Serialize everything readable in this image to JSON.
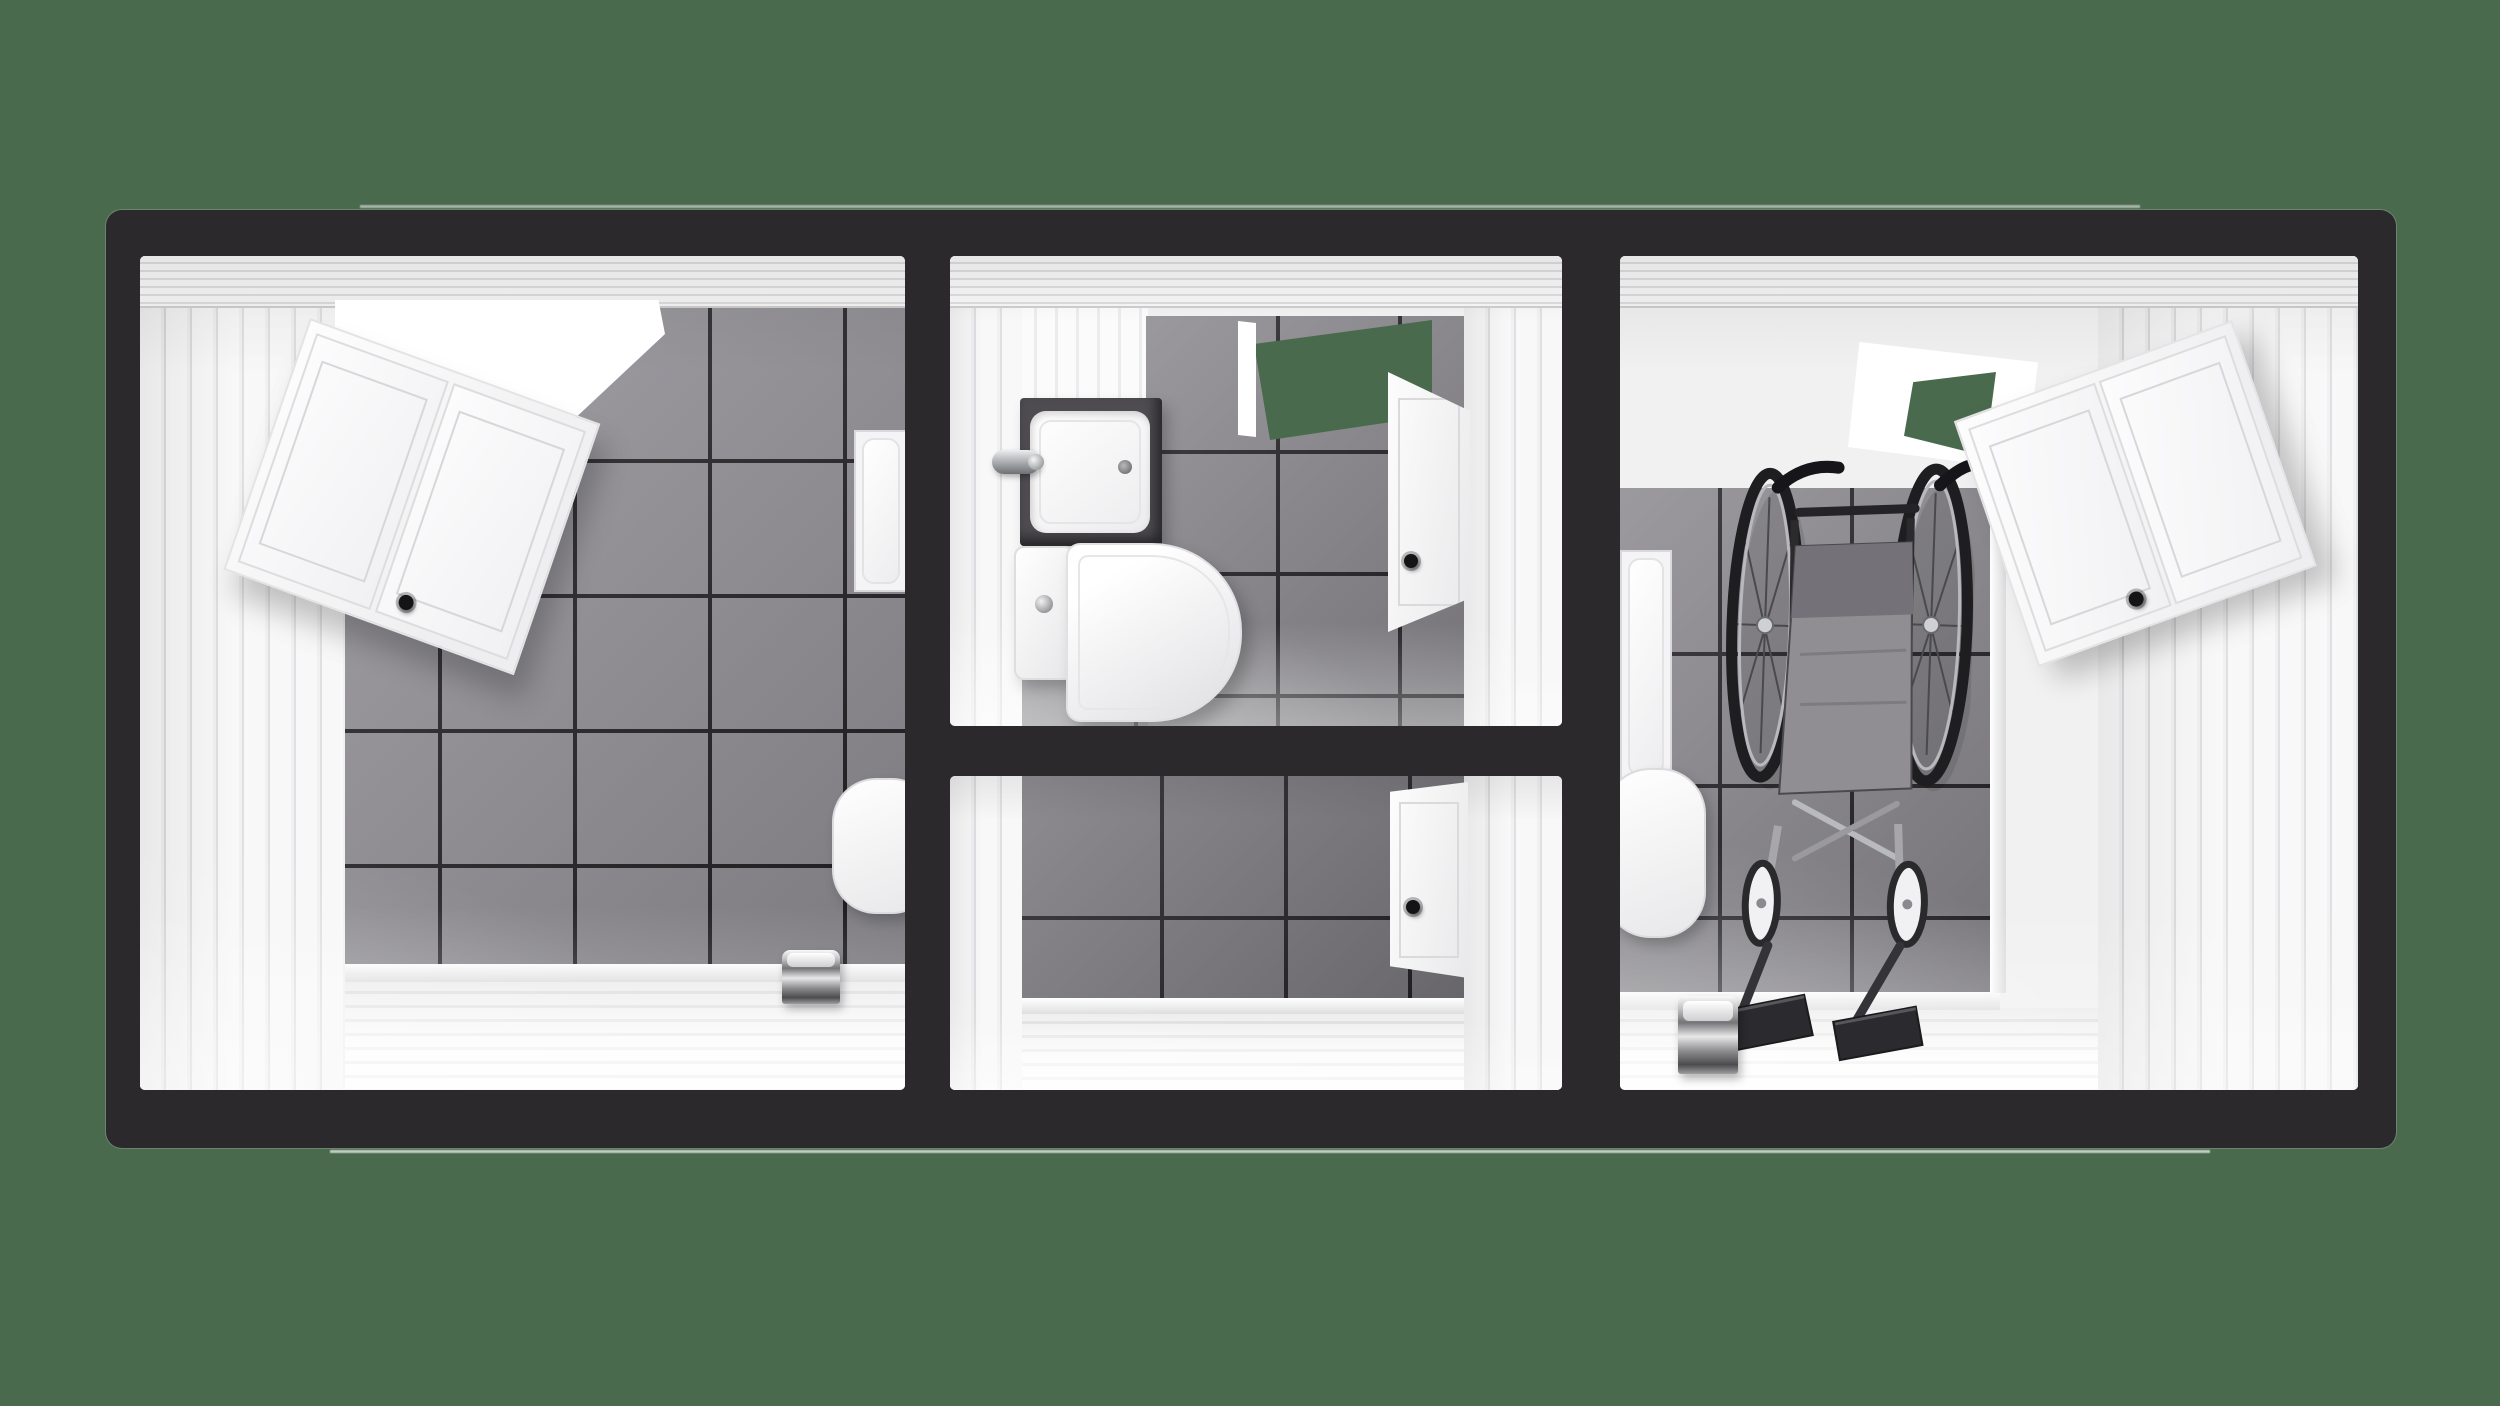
{
  "title": "Three-room modular sanitary container, top-down cutaway 3D render on transparent green background",
  "colors": {
    "bg-green": "#4a6a4e",
    "frame": "#2b292c",
    "grout": "#232125",
    "tile-light": "#949298",
    "tile-mid": "#8a888d",
    "tile-dark": "#7b797e",
    "plank-white": "#f2f1f2"
  },
  "container": {
    "frame_material": "dark charcoal steel frame",
    "room_count": 3,
    "layout": "left washroom | central double stall | right accessible washroom"
  },
  "rooms": {
    "left": {
      "label": "Left washroom: white plank walls and floor, gray tiled wall, wall cabinet with black knob, ceiling skylight, shower tray, toilet lid, chrome toilet-paper holder",
      "fixtures": [
        "wall-cabinet",
        "skylight",
        "tiled-wall",
        "shower-tray",
        "toilet",
        "toilet-paper-holder"
      ]
    },
    "wc_stall": {
      "label": "Central WC stall: vanity sink with chrome faucet, close-coupled toilet with chrome flush button, open door with black knob, open doorway to outside",
      "fixtures": [
        "sink-vanity",
        "faucet",
        "toilet",
        "door",
        "doorway-opening",
        "tiled-wall"
      ]
    },
    "shower_stall": {
      "label": "Central lower stall: empty tiled room with white door and black knob",
      "fixtures": [
        "door",
        "tiled-wall",
        "plank-floor"
      ]
    },
    "right": {
      "label": "Right accessible washroom: folded wheelchair on tiled wall, wall cabinet with black knob, skylight vent, shower tray, toilet lid, chrome toilet-paper holder",
      "fixtures": [
        "wheelchair",
        "wall-cabinet",
        "skylight-vent",
        "tiled-wall",
        "shower-tray",
        "toilet",
        "toilet-paper-holder"
      ]
    }
  }
}
